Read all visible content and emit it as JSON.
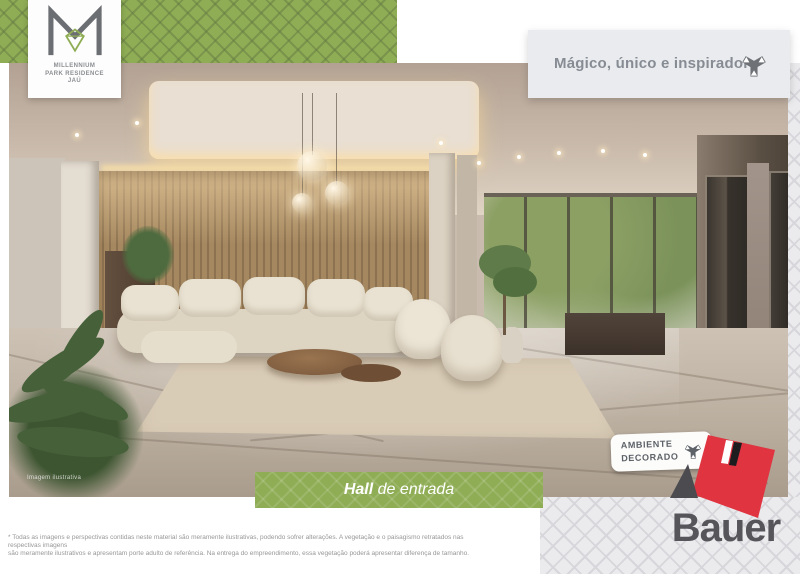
{
  "brand": {
    "name_line1": "MILLENNIUM",
    "name_line2": "PARK RESIDENCE",
    "name_line3": "JAÚ"
  },
  "tagline": "Mágico, único e inspirador",
  "caption": {
    "highlight": "Hall",
    "rest": " de entrada"
  },
  "badge": {
    "line1": "AMBIENTE",
    "line2": "DECORADO"
  },
  "builder": {
    "name": "Bauer"
  },
  "photo": {
    "watermark": "Imagem ilustrativa"
  },
  "disclaimer": {
    "line1": "* Todas as imagens e perspectivas contidas neste material são meramente ilustrativas, podendo sofrer alterações. A vegetação e o paisagismo retratados nas respectivas imagens",
    "line2": "são meramente ilustrativos e apresentam porte adulto de referência. Na entrega do empreendimento, essa vegetação poderá apresentar diferença de tamanho."
  },
  "colors": {
    "brand_green": "#8fad55",
    "pattern_gray": "#ebebee",
    "accent_red": "#e03440",
    "text_gray": "#878c94",
    "dark_gray": "#55555a"
  }
}
